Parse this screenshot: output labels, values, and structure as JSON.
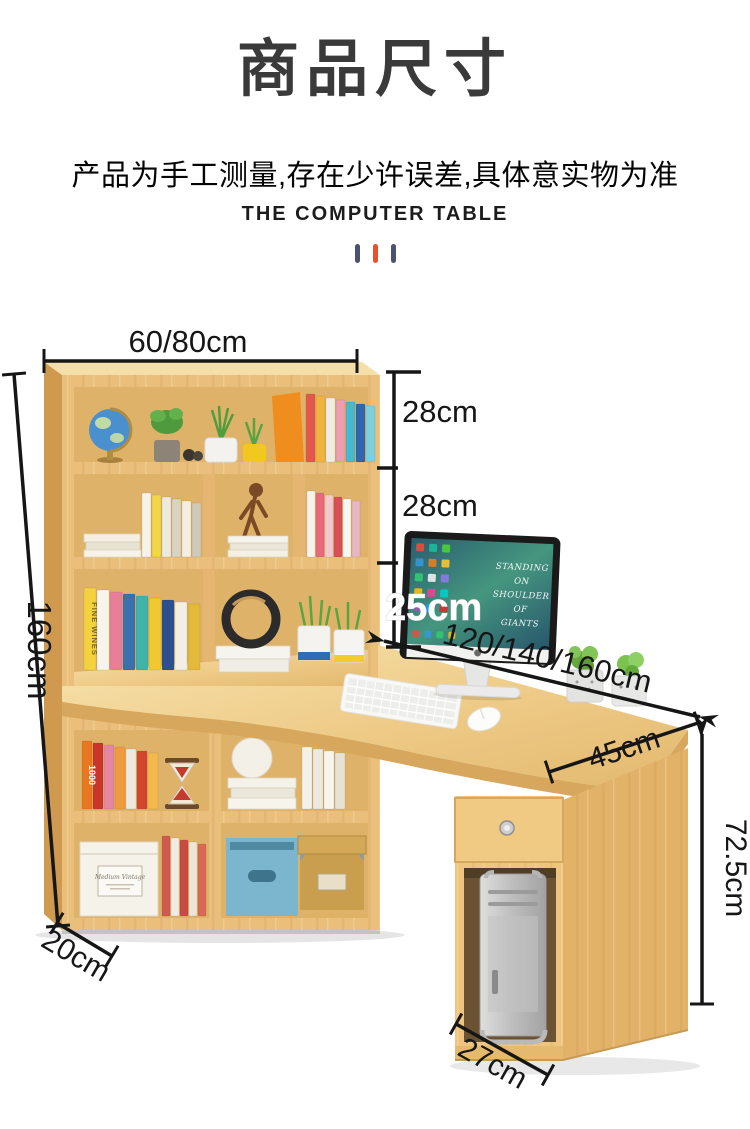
{
  "header": {
    "title": "商品尺寸",
    "subtitle": "产品为手工测量,存在少许误差,具体意实物为准",
    "caption": "THE COMPUTER TABLE",
    "divider_colors": [
      "#4a5173",
      "#e8502e",
      "#4a5173"
    ]
  },
  "diagram": {
    "dimensions": {
      "hutch_width": "60/80cm",
      "shelf_top_height": "28cm",
      "shelf_middle_height": "28cm",
      "shelf_bottom_height": "25cm",
      "total_height": "160cm",
      "desk_length": "120/140/160cm",
      "desk_depth": "45cm",
      "desk_height": "72.5cm",
      "bookcase_depth": "20cm",
      "pc_cabinet_width": "27cm"
    },
    "screen_text": [
      "STANDING",
      "ON",
      "SHOULDER",
      "OF",
      "GIANTS"
    ],
    "spine_texts": {
      "row3_first": "FINE WINES",
      "row4_first": "1000"
    },
    "storage_box_label": "Medium Vintage",
    "colors": {
      "wood_front": "#e9bf7b",
      "wood_top": "#f4dfa9",
      "wood_side": "#cf9a50",
      "wood_interior": "#dfb269",
      "desk_top": "#f0d195",
      "desk_edge": "#d7a75d",
      "line": "#161616"
    },
    "decor": {
      "books": [
        {
          "id": "books-row1",
          "x": 306,
          "bottom": 132,
          "w": 9,
          "h": 68,
          "colors": [
            "#e2574c",
            "#f0b43c",
            "#efece4",
            "#ef9db0",
            "#45b9cf",
            "#2f66ad",
            "#7fd0dd"
          ]
        },
        {
          "id": "books-row2-left",
          "x": 142,
          "bottom": 227,
          "w": 9,
          "h": 64,
          "colors": [
            "#f5f2e8",
            "#f0d747",
            "#eceade",
            "#d9d3c4",
            "#f4eee0",
            "#cfc9bb"
          ]
        },
        {
          "id": "books-row2-right",
          "x": 307,
          "bottom": 227,
          "w": 8,
          "h": 66,
          "colors": [
            "#f6f3ee",
            "#e86a7a",
            "#f3c9cf",
            "#d94f56",
            "#f7f7f3",
            "#e8b7c2"
          ]
        },
        {
          "id": "books-row3-left",
          "x": 84,
          "bottom": 340,
          "w": 12,
          "h": 82,
          "colors": [
            "#f3d23e",
            "#f7f4ec",
            "#e87f9a",
            "#3a6fb0",
            "#3fb3a9",
            "#efc832",
            "#2e4f8f",
            "#f2efe6",
            "#e2b93b"
          ]
        },
        {
          "id": "books-row4-left",
          "x": 82,
          "bottom": 479,
          "w": 10,
          "h": 68,
          "colors": [
            "#e87820",
            "#c9342b",
            "#e586a0",
            "#f09a3e",
            "#efe9dd",
            "#d4452f",
            "#f3b94a"
          ]
        },
        {
          "id": "books-row4-right",
          "x": 302,
          "bottom": 479,
          "w": 10,
          "h": 62,
          "colors": [
            "#f4f1e9",
            "#eceade",
            "#f7f5ee",
            "#e6e2d6"
          ]
        },
        {
          "id": "books-row5",
          "x": 162,
          "bottom": 586,
          "w": 8,
          "h": 80,
          "colors": [
            "#d05a4e",
            "#f1ece2",
            "#c94b40",
            "#ece5d8",
            "#d86a52"
          ]
        }
      ],
      "screen_icons": [
        "#e74c3c",
        "#3498db",
        "#2ecc71",
        "#f1c40f",
        "#9b59b6",
        "#1abc9c",
        "#e67e22",
        "#ecf0f1",
        "#e84393",
        "#00a8ff",
        "#4cd137",
        "#fbc531",
        "#8c7ae6",
        "#00cec9",
        "#d63031"
      ]
    }
  }
}
